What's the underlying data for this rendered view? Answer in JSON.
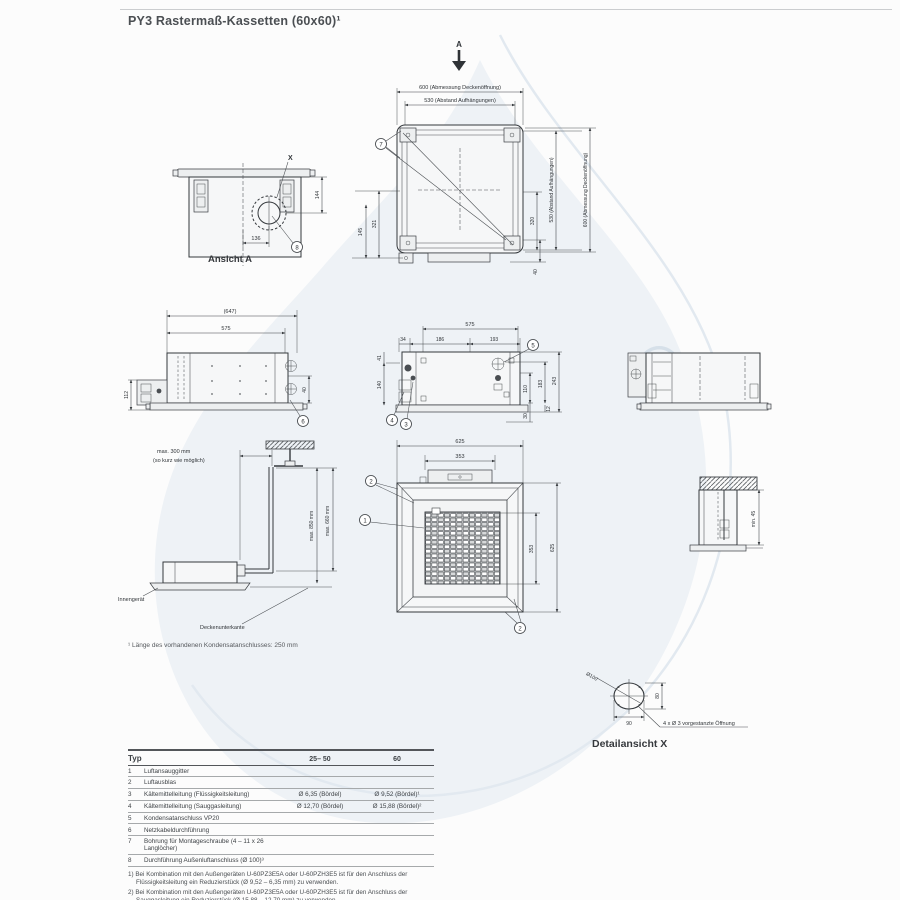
{
  "title": "PY3 Rastermaß-Kassetten (60x60)¹",
  "watermark": {
    "registered_symbol": "®",
    "color": "#d6e0e9"
  },
  "colors": {
    "line": "#34383c",
    "text": "#3e4246",
    "watermark_fill": "#eef2f6"
  },
  "drawings": {
    "section_arrow_label": "A",
    "plan_view": {
      "dim_top_outer": "600 (Abmessung Deckenöffnung)",
      "dim_top_inner": "530 (Abstand Aufhängungen)",
      "dim_left_outer": "145",
      "dim_left_inner": "321",
      "dim_right_inner": "320",
      "dim_right_mid": "530 (Abstand Aufhängungen)",
      "dim_right_outer": "600 (Abmessung Deckenöffnung)",
      "dim_bottom_right": "40",
      "callout_7": "7"
    },
    "ansicht_a": {
      "caption": "Ansicht A",
      "detail_marker": "X",
      "dim_width": "136",
      "dim_height": "144",
      "callout_8": "8"
    },
    "side_view_left": {
      "dim_top_outer": "(647)",
      "dim_top_inner": "575",
      "dim_left": "112",
      "dim_right": "40",
      "callout_6": "6"
    },
    "side_view_center": {
      "dim_top": "575",
      "dim_a": "34",
      "dim_b": "186",
      "dim_c": "193",
      "dim_left_top": "41",
      "dim_left_bottom": "140",
      "dim_right_inner": "110",
      "dim_right_mid": "183",
      "dim_right_outer": "243",
      "dim_bottom_small": "12",
      "dim_bottom": "30",
      "callout_5": "5",
      "callout_4": "4",
      "callout_3": "3"
    },
    "drain_diagram": {
      "note_line1": "max. 300 mm",
      "note_line2": "(so kurz wie möglich)",
      "dim_inner": "max. 850 mm",
      "dim_outer": "max. 660 mm",
      "label_unit": "Innengerät",
      "label_ceiling": "Deckenunterkante"
    },
    "panel_view": {
      "dim_top_outer": "625",
      "dim_top_inner": "353",
      "dim_right_inner": "353",
      "dim_right_outer": "625",
      "callout_1": "1",
      "callout_2_top": "2",
      "callout_2_bottom": "2"
    },
    "ceiling_section": {
      "dim_min": "min. 45"
    },
    "detail_x": {
      "caption": "Detailansicht X",
      "dim_diameter": "Ø100",
      "dim_height": "80",
      "dim_width": "90",
      "note": "4 x Ø 3 vorgestanzte Öffnung"
    },
    "footnote": "¹ Länge des vorhandenen Kondensatanschlusses: 250 mm"
  },
  "table": {
    "headers": [
      "Typ",
      "25– 50",
      "60"
    ],
    "rows": [
      {
        "no": "1",
        "label": "Luftansauggitter",
        "col1": "",
        "col2": ""
      },
      {
        "no": "2",
        "label": "Luftausblas",
        "col1": "",
        "col2": ""
      },
      {
        "no": "3",
        "label": "Kältemittelleitung (Flüssigkeitsleitung)",
        "col1": "Ø 6,35 (Bördel)",
        "col2": "Ø 9,52 (Bördel)¹"
      },
      {
        "no": "4",
        "label": "Kältemittelleitung (Sauggasleitung)",
        "col1": "Ø 12,70 (Bördel)",
        "col2": "Ø 15,88 (Bördel)²"
      },
      {
        "no": "5",
        "label": "Kondensatanschluss VP20",
        "col1": "",
        "col2": ""
      },
      {
        "no": "6",
        "label": "Netzkabeldurchführung",
        "col1": "",
        "col2": ""
      },
      {
        "no": "7",
        "label": "Bohrung für Montageschraube (4 – 11 x 26 Langlöcher)",
        "col1": "",
        "col2": ""
      },
      {
        "no": "8",
        "label": "Durchführung Außenluftanschluss (Ø 100)³",
        "col1": "",
        "col2": ""
      }
    ],
    "footnotes": [
      "1) Bei Kombination mit den Außengeräten U-60PZ3E5A oder U-60PZH3E5 ist für den Anschluss der Flüssigkeitsleitung ein Reduzierstück (Ø 9,52 – 6,35 mm) zu verwenden.",
      "2) Bei Kombination mit den Außengeräten U-60PZ3E5A oder U-60PZH3E5 ist für den Anschluss der Sauggasleitung ein Reduzierstück (Ø 15,88 – 12,70 mm) zu verwenden.",
      "3) Außenluftansaugstutzen erforderlich (bauseits)"
    ],
    "filter_note": "Filtergröße: 362 x 362 x 15 mm."
  }
}
